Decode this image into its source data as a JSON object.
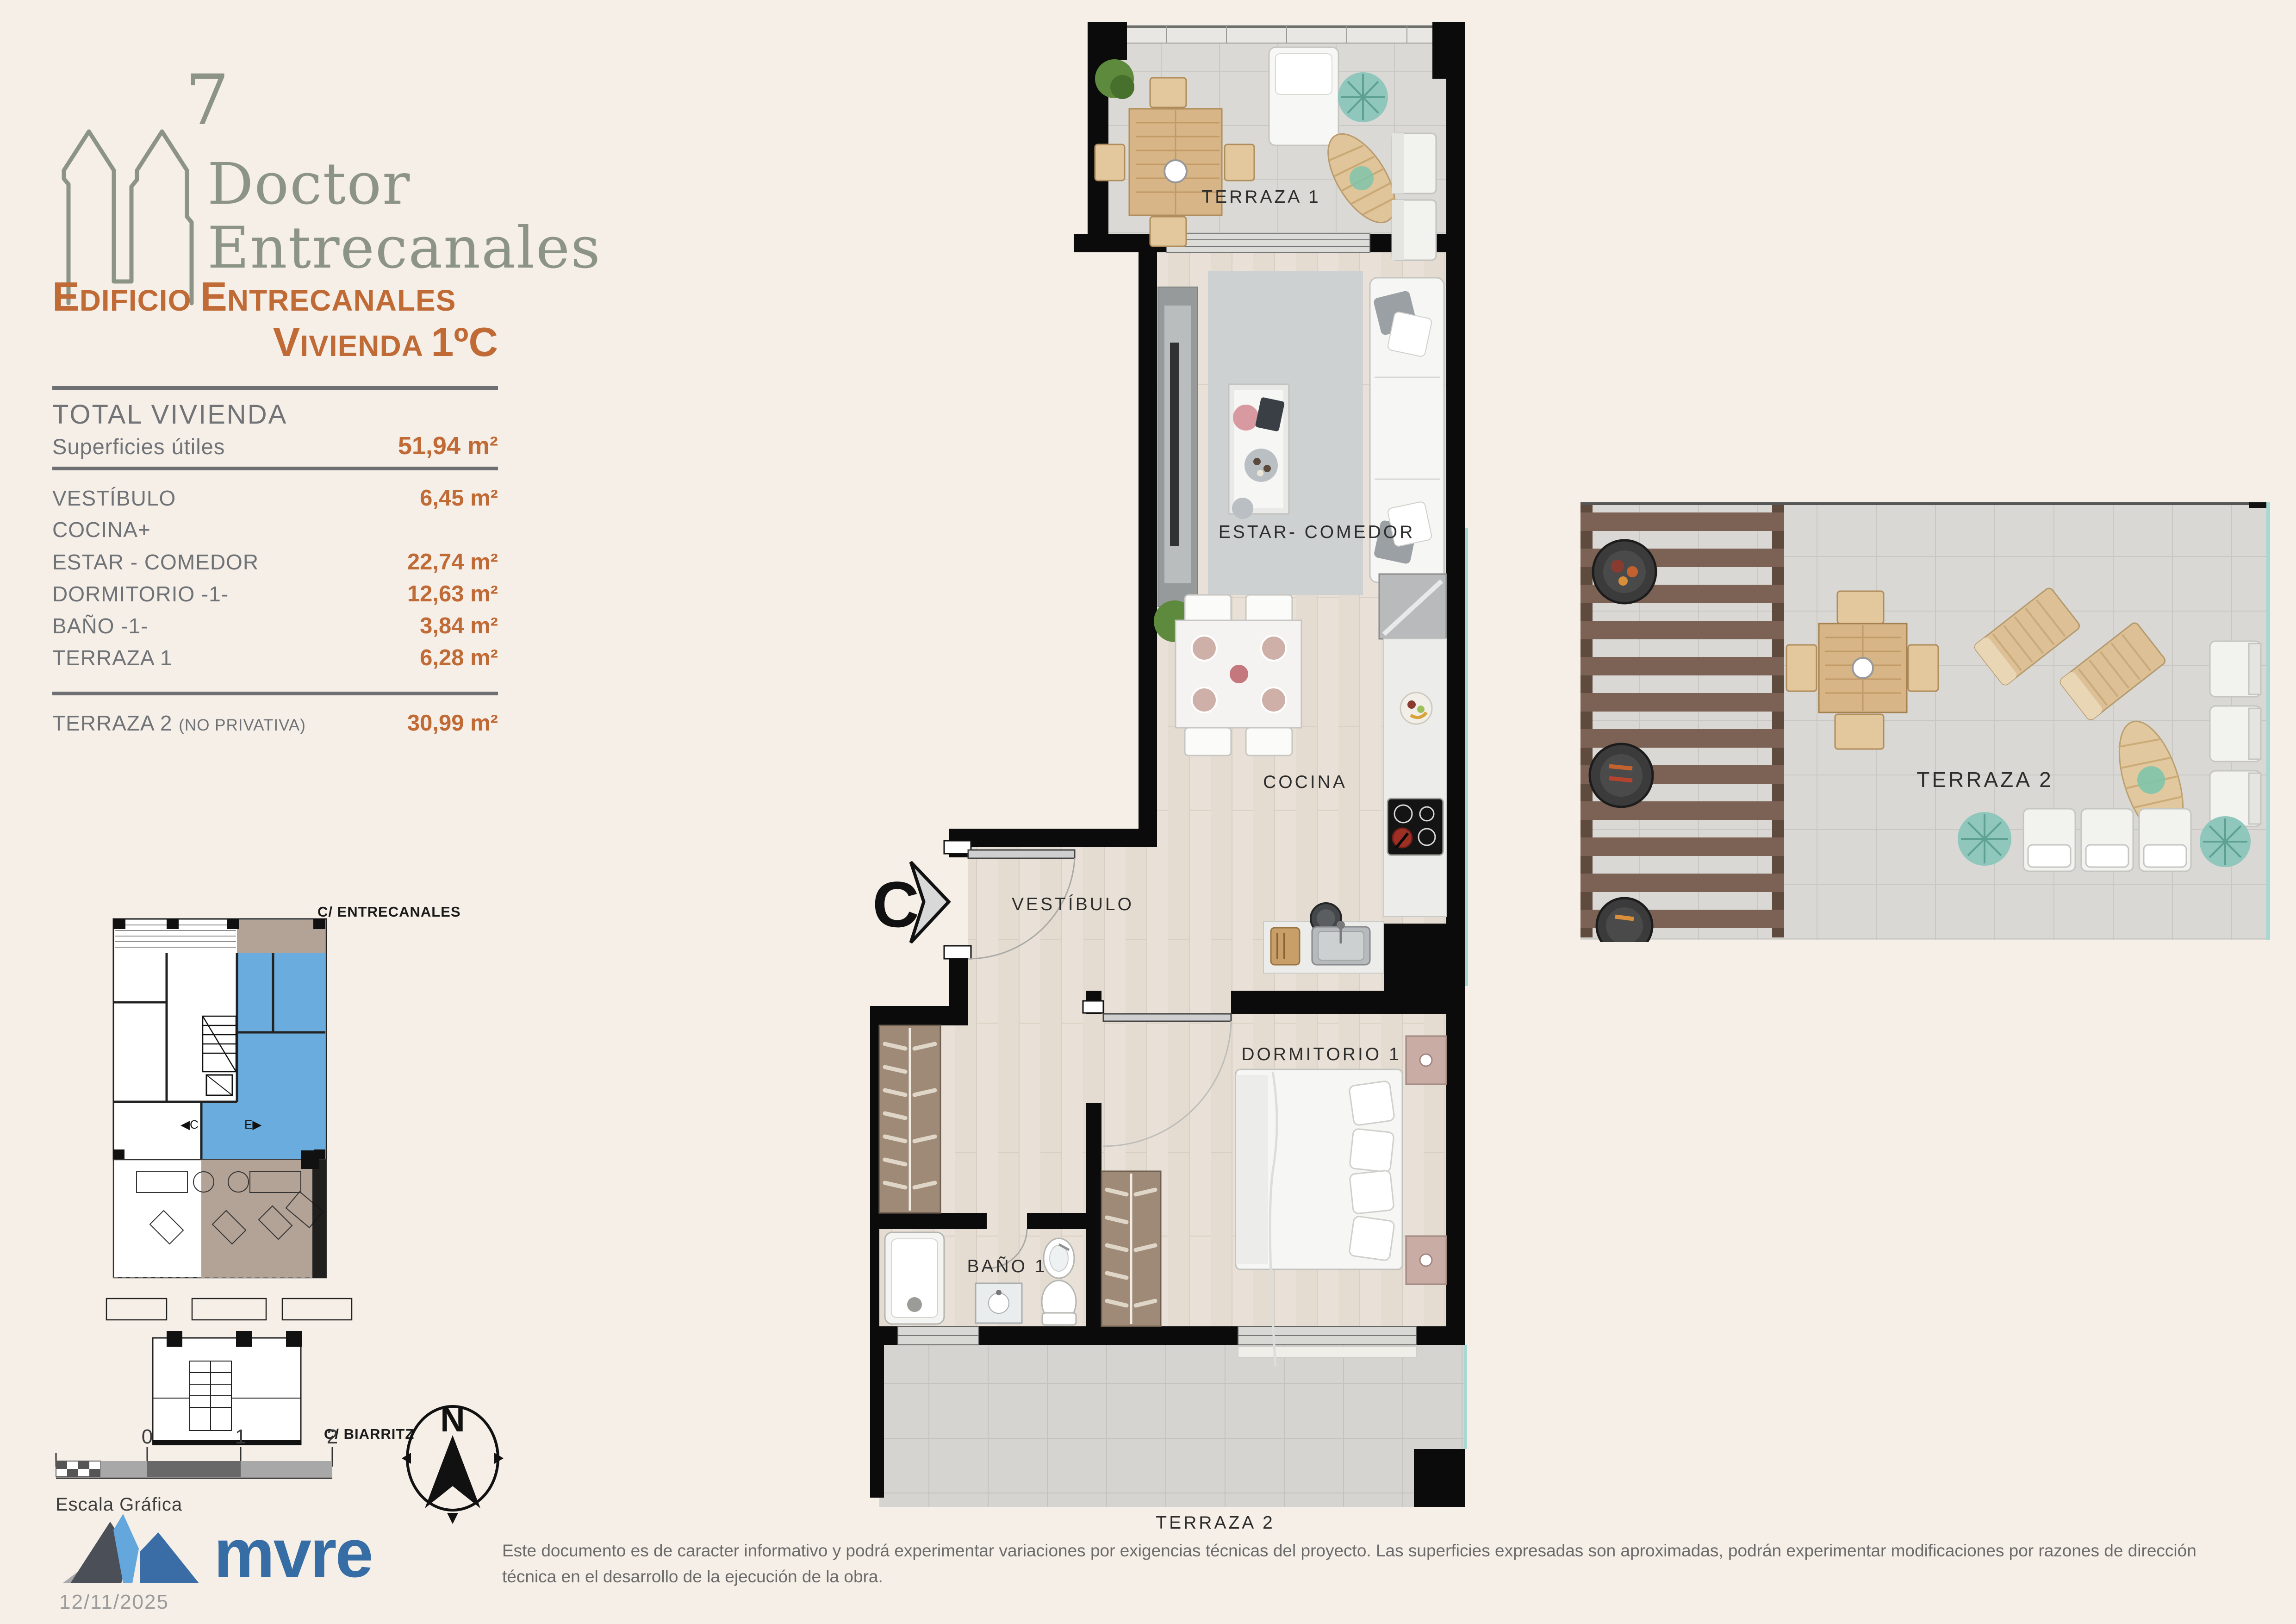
{
  "logo": {
    "number": "7",
    "name_line1": "Doctor",
    "name_line2": "Entrecanales"
  },
  "header": {
    "line1": {
      "cap1": "E",
      "rest1": "DIFICIO ",
      "cap2": "E",
      "rest2": "NTRECANALES"
    },
    "line2": {
      "cap1": "V",
      "rest1": "IVIENDA ",
      "num": "1ºC"
    }
  },
  "surfaces": {
    "total_label": "TOTAL VIVIENDA",
    "useful_label": "Superficies útiles",
    "total_value": "51,94 m²",
    "rows": [
      {
        "label": "VESTÍBULO",
        "value": "6,45 m²"
      },
      {
        "label": "COCINA+",
        "value": ""
      },
      {
        "label": "ESTAR - COMEDOR",
        "value": "22,74 m²"
      },
      {
        "label": "DORMITORIO -1-",
        "value": "12,63 m²"
      },
      {
        "label": "BAÑO -1-",
        "value": "3,84 m²"
      },
      {
        "label": "TERRAZA 1",
        "value": "6,28 m²"
      }
    ],
    "terraza2_label": "TERRAZA 2 ",
    "terraza2_note": "(NO PRIVATIVA)",
    "terraza2_value": "30,99 m²"
  },
  "floor_plan": {
    "terraza1": "TERRAZA 1",
    "estar": "ESTAR- COMEDOR",
    "cocina": "COCINA",
    "vestibulo": "VESTÍBULO",
    "dormitorio": "DORMITORIO 1",
    "bano": "BAÑO 1",
    "terraza2": "TERRAZA 2",
    "entrance": "C"
  },
  "terrace_plan": {
    "label": "TERRAZA 2"
  },
  "site_plan": {
    "street_top": "C/ ENTRECANALES",
    "street_bottom": "C/ BIARRITZ",
    "marker_c": "C",
    "marker_e": "E"
  },
  "scale_bar": {
    "label": "Escala Gráfica",
    "ticks": [
      "0",
      "1",
      "2"
    ]
  },
  "compass": {
    "north": "N"
  },
  "footer": {
    "brand": "mvre",
    "date": "12/11/2025",
    "disclaimer": "Este documento es de caracter informativo y podrá experimentar variaciones por exigencias técnicas del proyecto. Las superficies expresadas son aproximadas, podrán experimentar modificaciones por razones de dirección técnica en el desarrollo de la ejecución de la obra."
  },
  "colors": {
    "accent_orange": "#c06a36",
    "logo_sage": "#8c9486",
    "brand_blue": "#356da4",
    "unit_highlight": "#69acdd"
  }
}
